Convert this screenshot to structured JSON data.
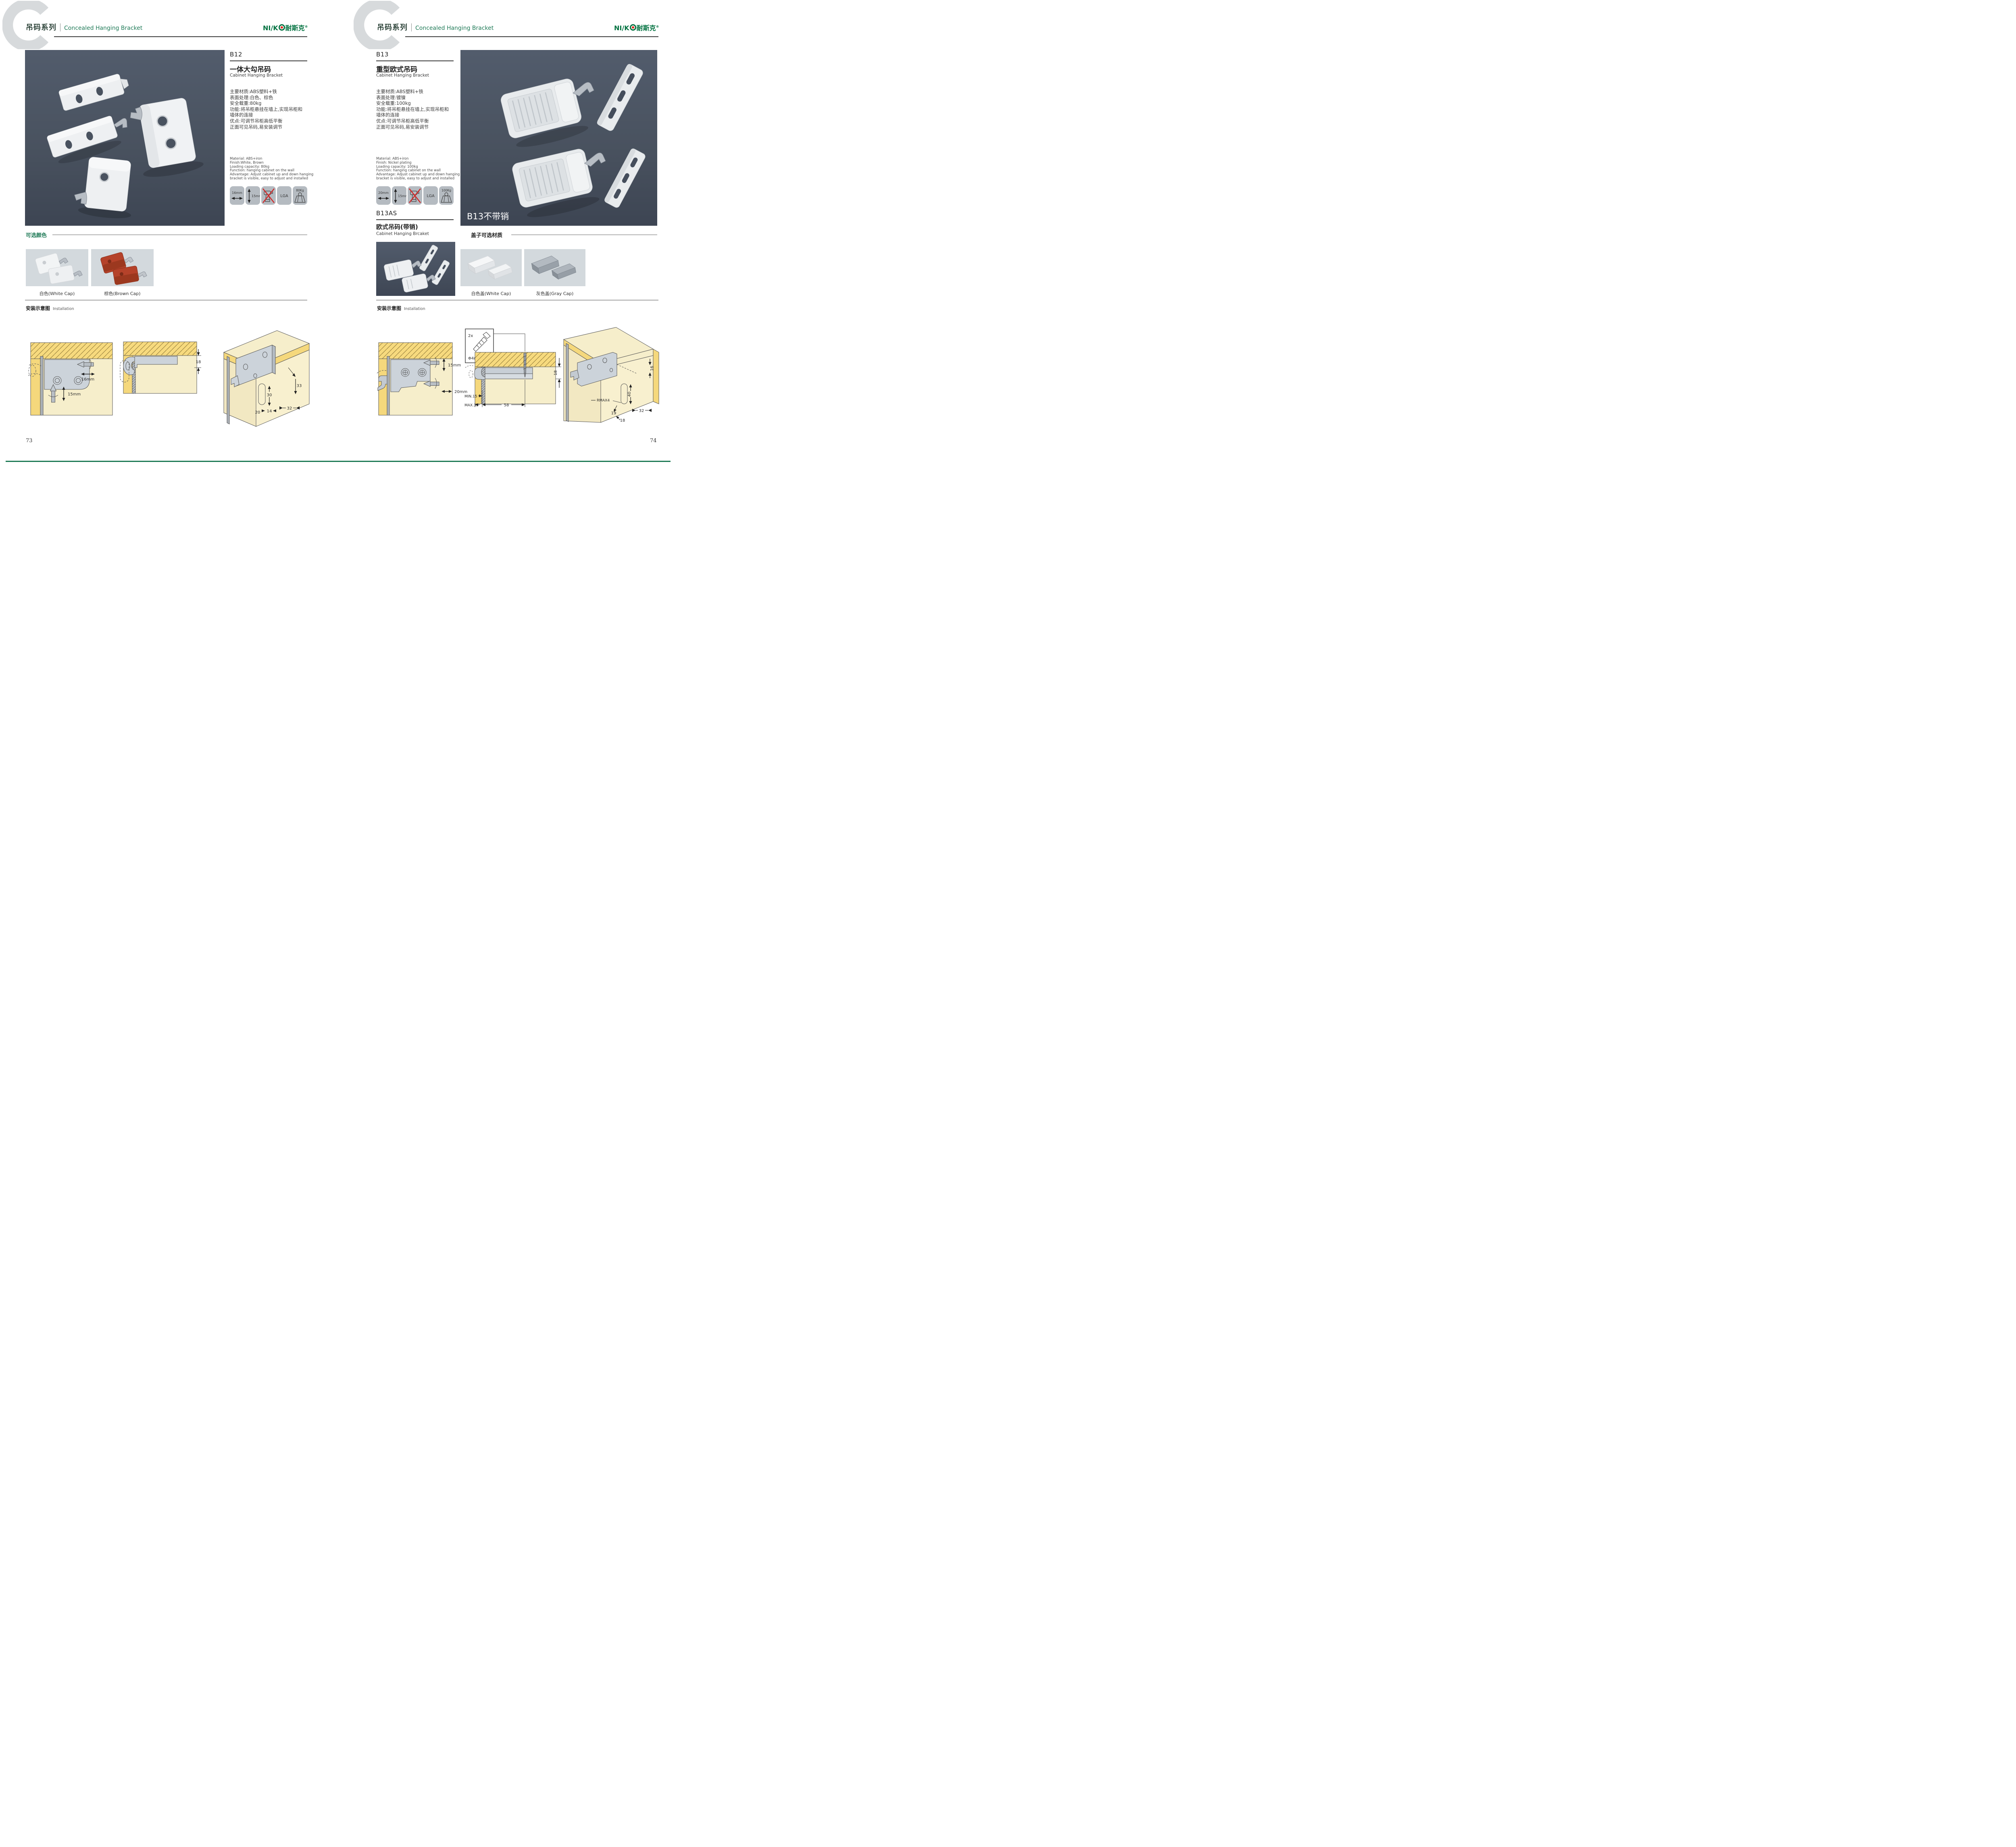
{
  "brand": {
    "logo_latin": "NI/K",
    "logo_cn": "耐斯克",
    "reg": "®"
  },
  "header": {
    "watermark": "C",
    "series_cn": "吊码系列",
    "series_en": "Concealed Hanging Bracket"
  },
  "left": {
    "page_no": "73",
    "model": "B12",
    "name_cn": "一体大勾吊码",
    "name_en": "Cabinet Hanging Bracket",
    "specs_cn": [
      "主要材质:ABS塑料+铁",
      "表面处理:白色、棕色",
      "安全载重:80kg",
      "功能:将吊柜悬挂在墙上,实现吊柜和",
      "墙体的连接",
      "优点:可调节吊柜高低平衡",
      "正面可见吊码,易安装调节"
    ],
    "specs_en": [
      "Material: ABS+iron",
      "Finish:White, Brown",
      "Loading capacity: 80kg",
      "Function: hanging cabinet on the wall",
      "Advantage: Adjust cabinet up and down hanging",
      "bracket is visible, easy to adjust and installed"
    ],
    "icons": {
      "width": "16mm",
      "height": "15mm",
      "cert": "LGA",
      "load": "80Kg"
    },
    "colors_heading": "可选颜色",
    "color_options": [
      {
        "label": "白色(White Cap)"
      },
      {
        "label": "棕色(Brown Cap)"
      }
    ],
    "install_cn": "安装示意图",
    "install_en": "Installation",
    "d1": {
      "w": "16mm",
      "h": "15mm"
    },
    "d2": {
      "t": "18"
    },
    "d3": {
      "a": "33",
      "b": "30",
      "c": "32",
      "d": "20",
      "e": "14"
    }
  },
  "right": {
    "page_no": "74",
    "model": "B13",
    "name_cn": "重型欧式吊码",
    "name_en": "Cabinet Hanging Bracket",
    "specs_cn": [
      "主要材质:ABS塑料+铁",
      "表面处理:镀镍",
      "安全载重:100kg",
      "功能:将吊柜悬挂在墙上,实现吊柜和",
      "墙体的连接",
      "优点:可调节吊柜高低平衡",
      "正面可见吊码,易安装调节"
    ],
    "specs_en": [
      "Material: ABS+iron",
      "Finish: Nickel plating",
      "Loading capacity: 100kg",
      "Function: hanging cabinet on the wall",
      "Advantage: Adjust cabinet up and down hanging",
      "bracket is visible, easy to adjust and installed"
    ],
    "icons": {
      "width": "20mm",
      "height": "15mm",
      "cert": "LGA",
      "load": "100Kg"
    },
    "photo_label": "B13不带销",
    "sub_model": "B13AS",
    "sub_name_cn": "欧式吊码(带销)",
    "sub_name_en": "Cabinet Hanging Brcaket",
    "caps_heading": "盖子可选材质",
    "cap_options": [
      {
        "label": "白色盖(White Cap)"
      },
      {
        "label": "灰色盖(Gray Cap)"
      }
    ],
    "install_cn": "安装示意图",
    "install_en": "Installation",
    "d1": {
      "h": "15mm",
      "w": "20mm"
    },
    "d2": {
      "count": "2x",
      "dia": "Φ4mm",
      "t": "18",
      "min": "MIN.15",
      "max": "MAX.35",
      "span": "58"
    },
    "d3": {
      "a": "16",
      "b": "40",
      "r": "RMAX4",
      "c": "19",
      "d": "32",
      "e": "18"
    }
  }
}
